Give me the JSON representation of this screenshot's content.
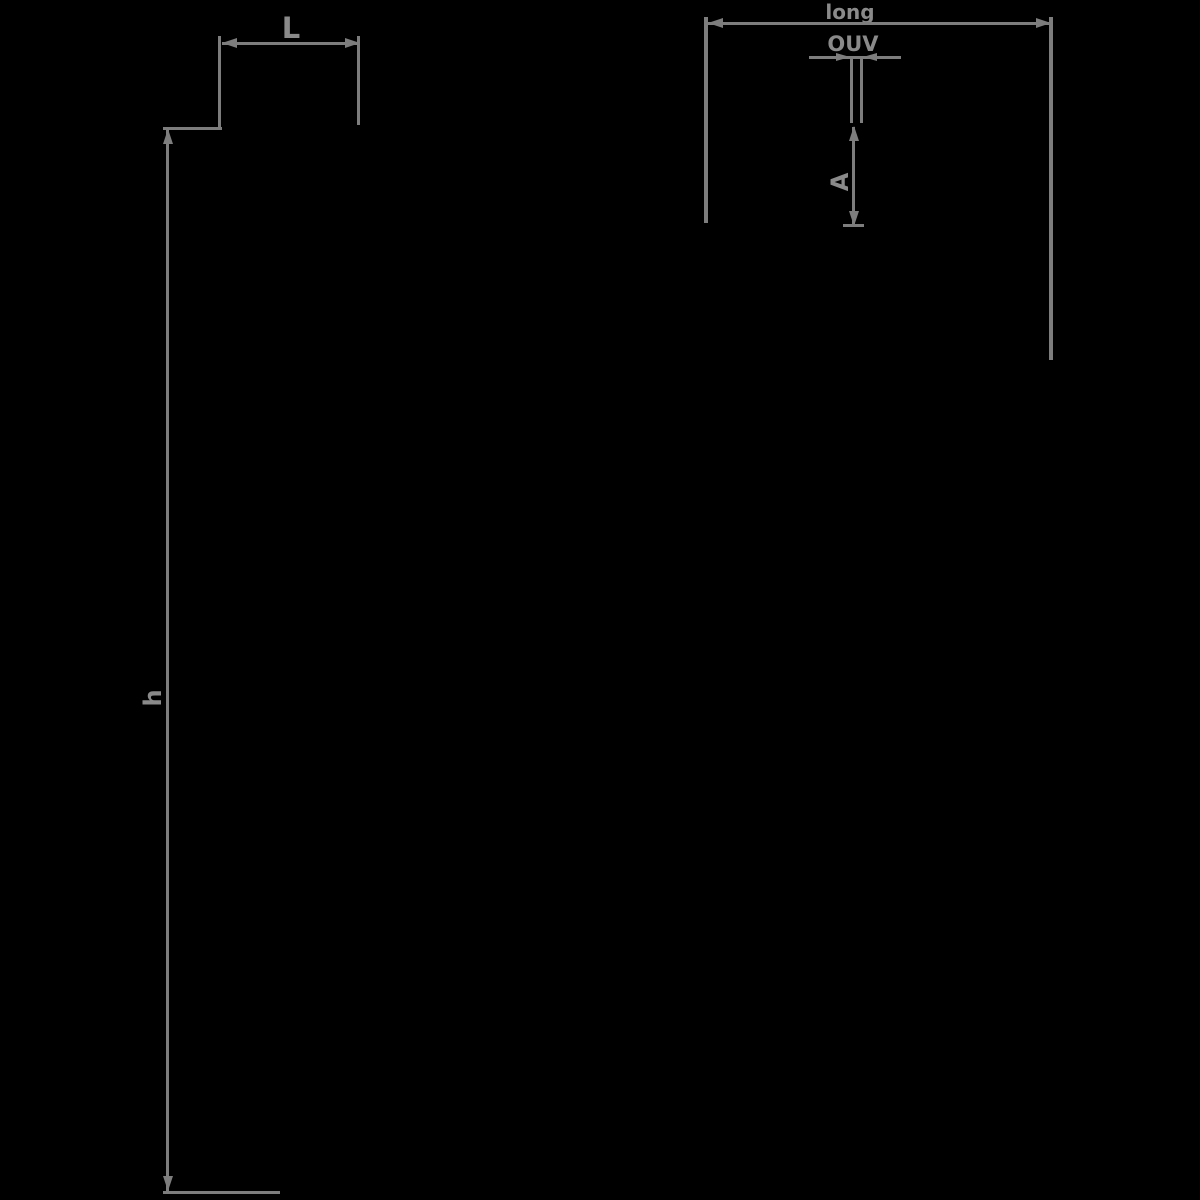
{
  "diagram": {
    "type": "technical-dimension-drawing",
    "background_color": "#000000",
    "line_color": "#7d7d7d",
    "text_color": "#8a8a8a",
    "dimensions": {
      "l": {
        "label": "L",
        "orientation": "horizontal"
      },
      "h": {
        "label": "h",
        "orientation": "vertical"
      },
      "long": {
        "label": "long",
        "orientation": "horizontal"
      },
      "ouv": {
        "label": "OUV",
        "orientation": "horizontal"
      },
      "a": {
        "label": "A",
        "orientation": "vertical"
      }
    }
  }
}
